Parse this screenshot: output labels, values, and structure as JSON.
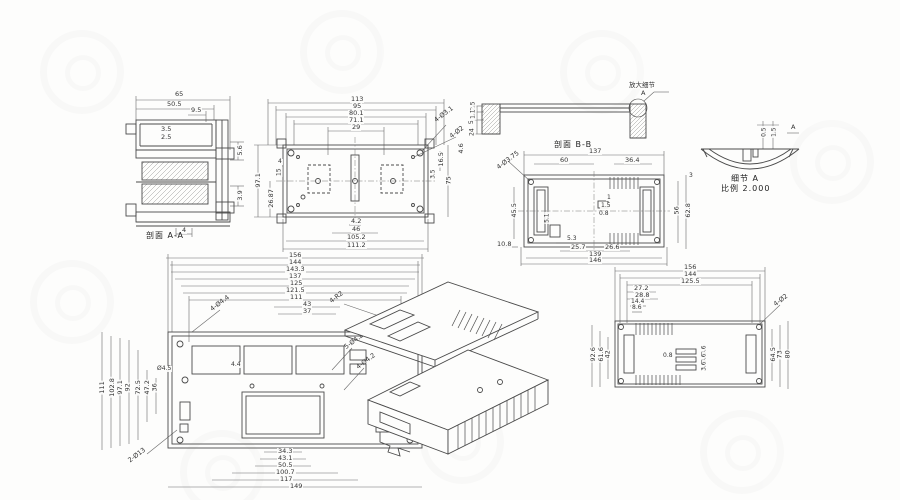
{
  "colors": {
    "line": "#4a4a4a",
    "dim_line": "#6a6a6a",
    "dim_text": "#333333",
    "background": "#fdfdfc"
  },
  "section_aa": {
    "title": "剖面  A-A",
    "dims": {
      "outer_width": "65",
      "inner_width": "50.5",
      "wall": "3.5",
      "rib": "2.5",
      "step": "9.5",
      "right_upper": "5.6",
      "right_lower": "3.9",
      "foot": "4"
    }
  },
  "top_view": {
    "top": [
      "113",
      "95",
      "80.1",
      "71.1",
      "29"
    ],
    "bottom": [
      "4.2",
      "46",
      "105.2",
      "111.2"
    ],
    "left": [
      "97.1",
      "26.87"
    ],
    "left_small": [
      "4",
      "15"
    ],
    "right": [
      "4.6",
      "16.5",
      "3.5",
      "75"
    ],
    "leaders": [
      "4-Ø3.1",
      "4-Ø2"
    ]
  },
  "section_bb": {
    "title": "剖面  B-B",
    "left": [
      "2.5",
      "1.1",
      "5",
      "24"
    ],
    "callout": "放大细节",
    "callout_ref": "A"
  },
  "detail_a": {
    "title": "细节  A",
    "scale": "比例  2.000",
    "dims": [
      "0.5",
      "1.5"
    ],
    "ref": "A"
  },
  "base_view": {
    "top": [
      "137",
      "60",
      "36.4"
    ],
    "bottom": [
      "5.3",
      "25.7",
      "26.6",
      "139",
      "146"
    ],
    "left": [
      "45.5",
      "10.8",
      "5.1"
    ],
    "right": [
      "56",
      "62.8",
      "3"
    ],
    "center_small": [
      "1",
      "1.5",
      "0.8"
    ],
    "leader": "4-Ø3.75"
  },
  "front_view": {
    "top": [
      "156",
      "144",
      "143.3",
      "137",
      "125",
      "121.5",
      "111",
      "43",
      "37"
    ],
    "bottom": [
      "34.3",
      "43.1",
      "50.5",
      "100.7",
      "117",
      "149"
    ],
    "left": [
      "111",
      "102.8",
      "97.1",
      "92",
      "72.5",
      "47.2",
      "36"
    ],
    "small": [
      "4.4",
      "Ø4.5"
    ],
    "leaders": [
      "4-Ø4.4",
      "4-R2",
      "5-Ø4.2",
      "4-Ø4.2",
      "2-Ø13"
    ]
  },
  "back_view": {
    "top": [
      "156",
      "144",
      "125.5",
      "27.2",
      "28.8",
      "14.4",
      "8.6"
    ],
    "left": [
      "92.6",
      "61.6",
      "42"
    ],
    "right": [
      "64.5",
      "73",
      "80"
    ],
    "small": [
      "0.8",
      "3.6",
      "3.6",
      "3.6"
    ],
    "leader": "4-Ø2"
  }
}
